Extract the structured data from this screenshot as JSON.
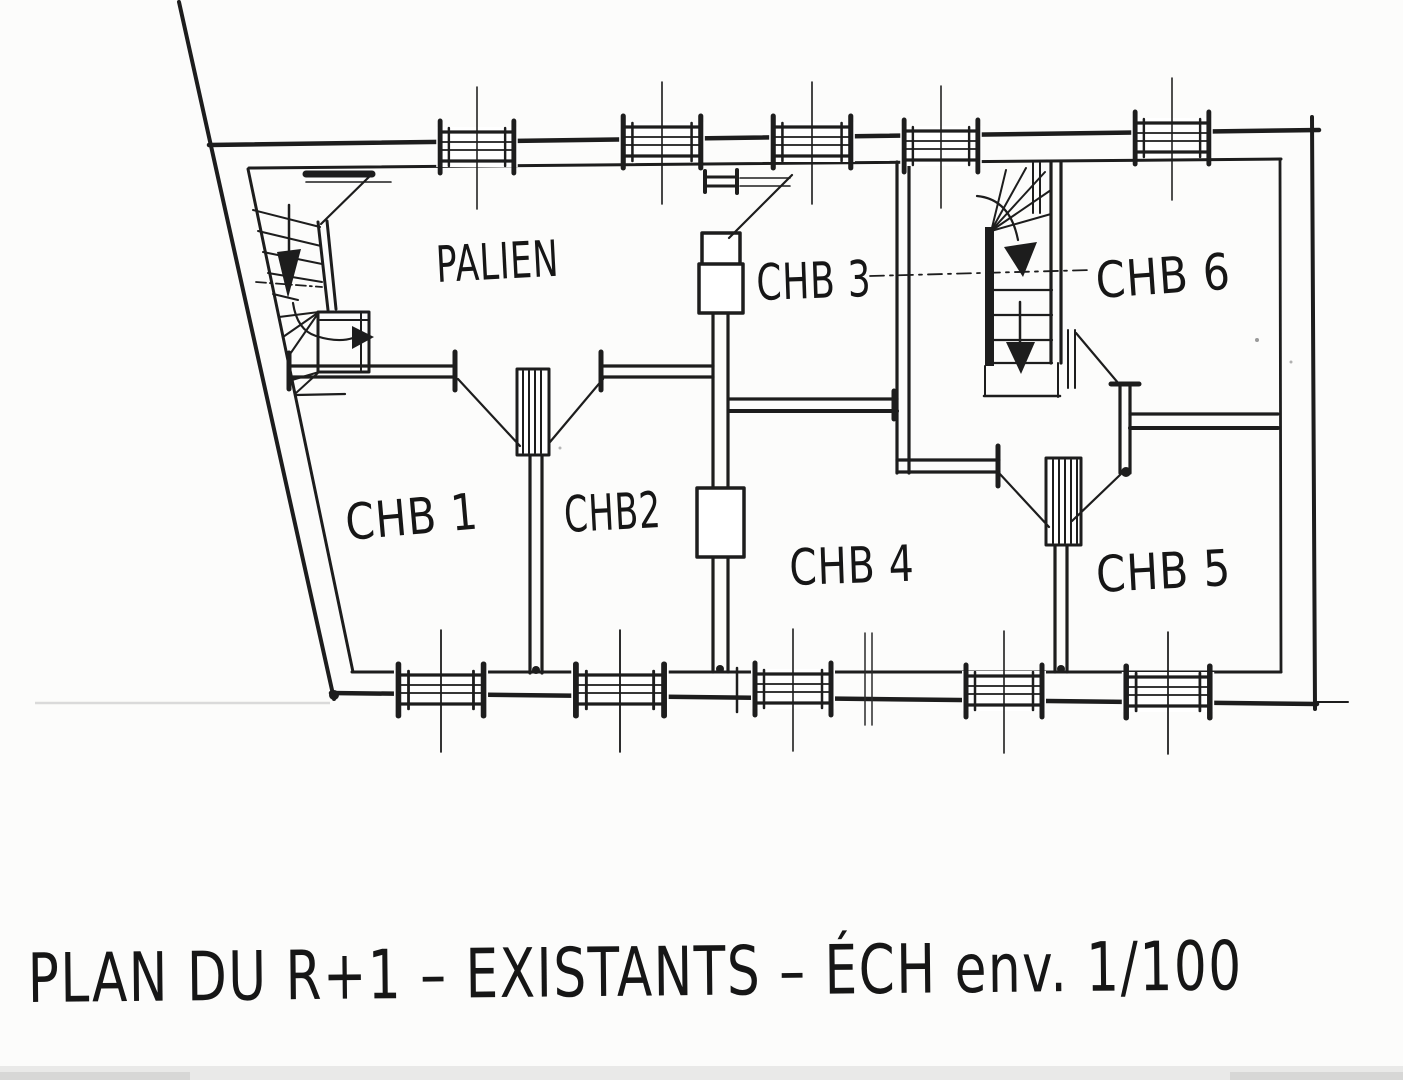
{
  "scan": {
    "paper_color": "#fcfcfb",
    "ink_color": "#1d1d1d"
  },
  "title": {
    "full": "PLAN DU R+1  – EXISTANTS  – ÉCH env. 1/100"
  },
  "rooms": {
    "palier": {
      "label": "PALIEN"
    },
    "chb1": {
      "label": "CHB 1"
    },
    "chb2": {
      "label": "CHB2"
    },
    "chb3": {
      "label": "CHB 3"
    },
    "chb4": {
      "label": "CHB 4"
    },
    "chb5": {
      "label": "CHB 5"
    },
    "chb6": {
      "label": "CHB 6"
    }
  }
}
